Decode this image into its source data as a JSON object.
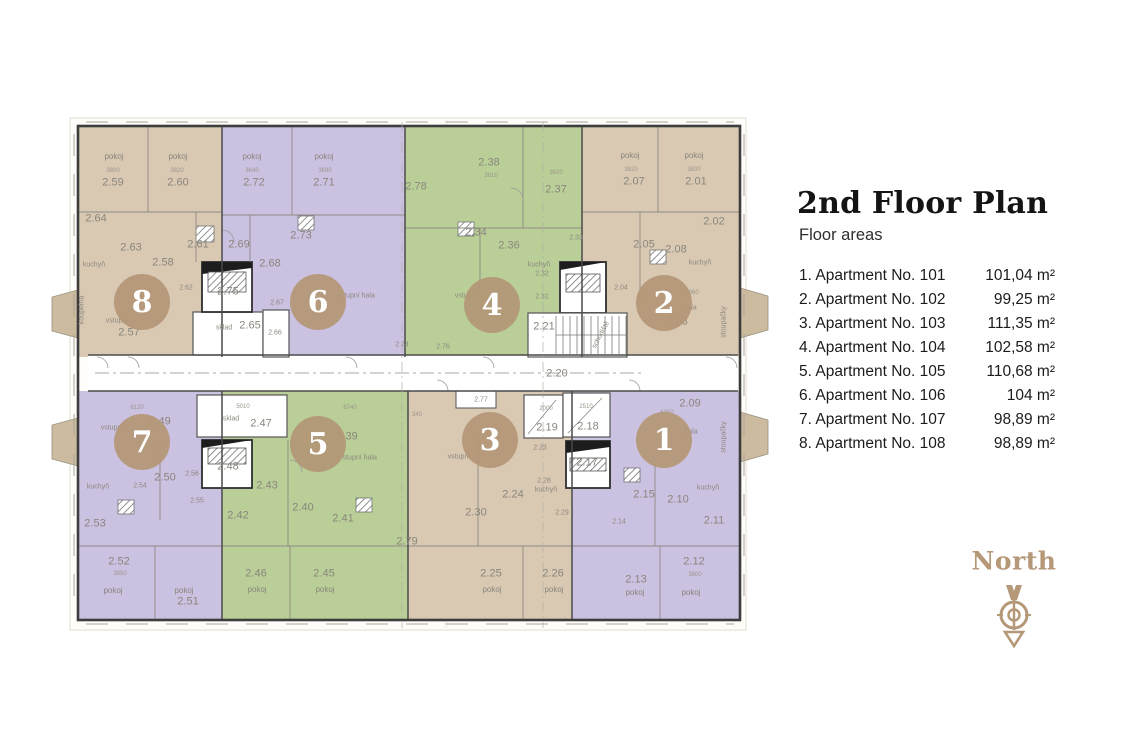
{
  "header": {
    "title": "2nd Floor Plan",
    "subtitle": "Floor areas"
  },
  "legend": {
    "apartments": [
      {
        "name": "1. Apartment No. 101",
        "area": "101,04 m²"
      },
      {
        "name": "2. Apartment No. 102",
        "area": "99,25 m²"
      },
      {
        "name": "3. Apartment No. 103",
        "area": "111,35 m²"
      },
      {
        "name": "4. Apartment No. 104",
        "area": "102,58 m²"
      },
      {
        "name": "5. Apartment No. 105",
        "area": "110,68 m²"
      },
      {
        "name": "6. Apartment No. 106",
        "area": "104 m²"
      },
      {
        "name": "7. Apartment No. 107",
        "area": "98,89 m²"
      },
      {
        "name": "8. Apartment No. 108",
        "area": "98,89 m²"
      }
    ]
  },
  "compass": {
    "label": "North"
  },
  "colors": {
    "beige": "#d9c8b2",
    "purple": "#cbc1e1",
    "green": "#b9cf97",
    "balcony": "#cdbb9f",
    "circle": "#b39876",
    "accent": "#b49878"
  },
  "plan": {
    "units": {
      "u8": {
        "number": "8",
        "rooms": [
          "pokoj",
          "3800",
          "2.59",
          "pokoj",
          "3820",
          "2.60",
          "2.64",
          "2.63",
          "2.61",
          "2.58",
          "2.62",
          "kuchyň",
          "vstupní",
          "2.57",
          "koupelna"
        ]
      },
      "u6": {
        "number": "6",
        "rooms": [
          "pokoj",
          "3640",
          "2.72",
          "pokoj",
          "3690",
          "2.71",
          "2.73",
          "2.69",
          "2.68",
          "2.67",
          "vstupní hala"
        ]
      },
      "u4": {
        "number": "4",
        "rooms": [
          "2.78",
          "2.38",
          "3610",
          "3620",
          "2.37",
          "2.34",
          "2.36",
          "2.33",
          "kuchyň",
          "2.32",
          "2.31",
          "vstupní",
          "2.76"
        ]
      },
      "u2": {
        "number": "2",
        "rooms": [
          "pokoj",
          "3820",
          "2.07",
          "pokoj",
          "3800",
          "2.01",
          "2.02",
          "2.05",
          "2.08",
          "kuchyň",
          "2.04",
          "3960",
          "hala",
          "2.03",
          "stoupačky"
        ]
      },
      "u7": {
        "number": "7",
        "rooms": [
          "6120",
          "2.49",
          "vstupní",
          "2.50",
          "2.56",
          "2.55",
          "kuchyň",
          "2.54",
          "2.53",
          "2.52",
          "3850",
          "pokoj",
          "pokoj",
          "2.51"
        ]
      },
      "u5": {
        "number": "5",
        "rooms": [
          "6740",
          "2.39",
          "vstupní hala",
          "2.43",
          "2.42",
          "2.40",
          "2.41",
          "2.46",
          "pokoj",
          "2.45",
          "pokoj",
          "2.79"
        ]
      },
      "u3": {
        "number": "3",
        "rooms": [
          "340",
          "vstupní",
          "2.23",
          "2.28",
          "kuchyň",
          "2.24",
          "2.30",
          "2.29",
          "2.25",
          "pokoj",
          "2.26",
          "pokoj"
        ]
      },
      "u1": {
        "number": "1",
        "rooms": [
          "2.09",
          "6950",
          "hala",
          "stoupačky",
          "2.15",
          "2.10",
          "kuchyň",
          "2.11",
          "2.14",
          "2.12",
          "3800",
          "2.13",
          "pokoj",
          "pokoj"
        ]
      }
    },
    "core": {
      "lift_a": "2.75",
      "sklad_a": "sklad",
      "r265": "2.65",
      "r266": "2.66",
      "stairs": "2.21",
      "stairs_word": "schodiště",
      "corridor": "2.20",
      "r274": "2.74",
      "sklad_b": "sklad",
      "dim_sklad_b": "5010",
      "r247": "2.47",
      "r248": "2.48",
      "r219": "2.19",
      "dim219": "2000",
      "r218": "2.18",
      "dim218": "2510",
      "r217": "2.17",
      "r277": "2.77"
    }
  }
}
